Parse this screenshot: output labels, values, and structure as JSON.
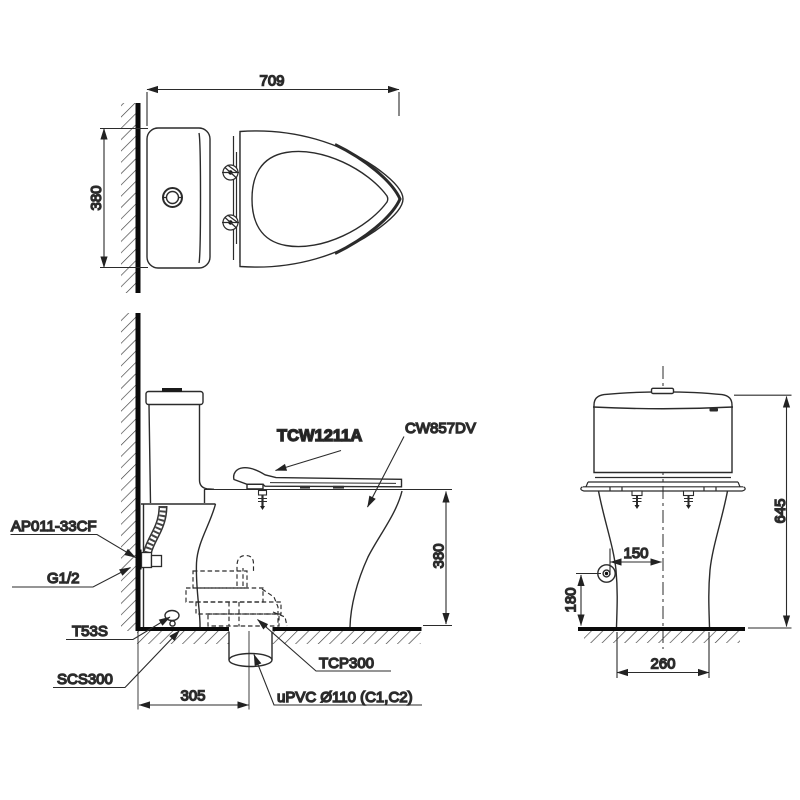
{
  "drawing": {
    "products": {
      "seat_model": "TCW1211A",
      "bowl_model": "CW857DV",
      "supply_hose": "AP011-33CF",
      "supply_thread": "G1/2",
      "seal_kit": "T53S",
      "floor_flange": "SCS300",
      "outlet_connector": "TCP300",
      "drain_pipe": "uPVC Ø110 (C1,C2)"
    },
    "dimensions": {
      "top_view": {
        "overall_depth": "709",
        "width": "380"
      },
      "side_view": {
        "rim_height": "380",
        "outlet_offset": "305"
      },
      "front_view": {
        "overall_height": "645",
        "inlet_offset": "150",
        "inlet_height": "180",
        "base_width": "260"
      }
    },
    "colors": {
      "line": "#2b2b2b",
      "heavy_line": "#0a0a0a",
      "background": "#ffffff"
    }
  }
}
